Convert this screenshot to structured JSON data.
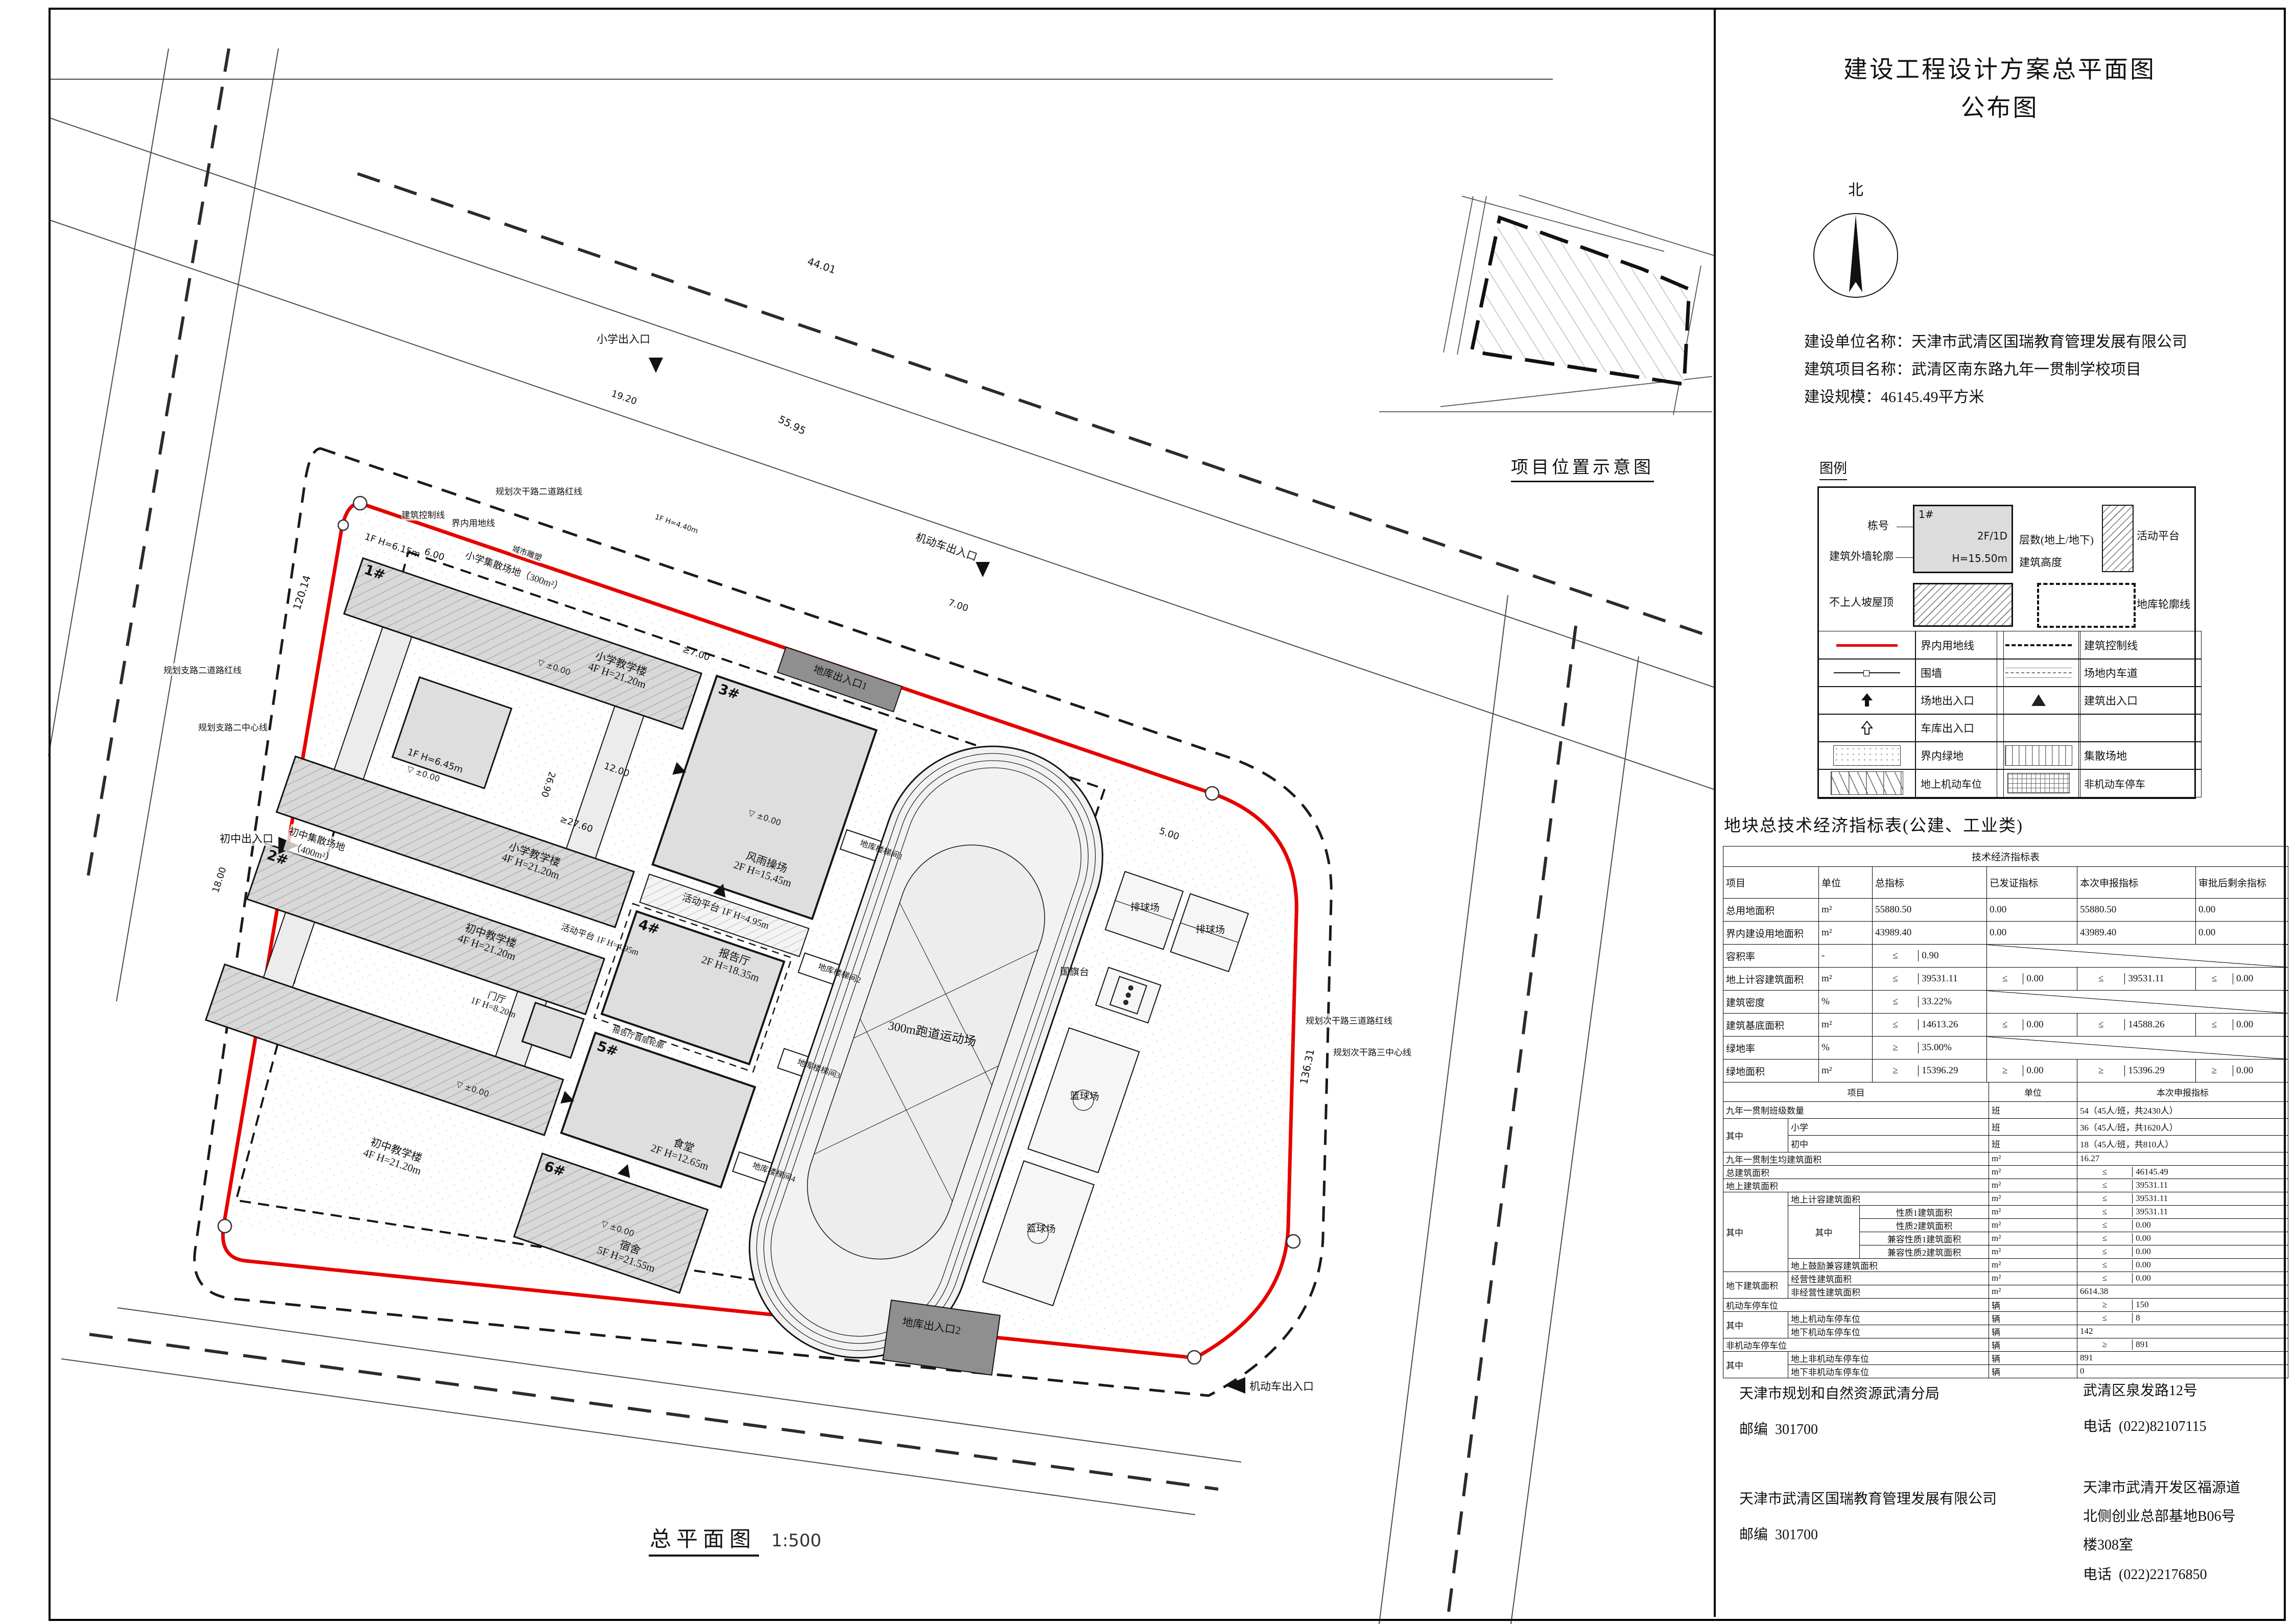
{
  "hdr": {
    "title1": "建设工程设计方案总平面图",
    "title2": "公布图",
    "north": "北"
  },
  "info": {
    "l1": "建设单位名称：天津市武清区国瑞教育管理发展有限公司",
    "l2": "建筑项目名称：武清区南东路九年一贯制学校项目",
    "l3": "建设规模：46145.49平方米"
  },
  "loc": {
    "title": "项目位置示意图"
  },
  "lg": {
    "title": "图例",
    "dong": "栋号",
    "dong_val": "1#",
    "wall": "建筑外墙轮廓",
    "floors_val": "2F/1D",
    "floors": "层数(地上/地下)",
    "h_val": "H=15.50m",
    "h": "建筑高度",
    "platform": "活动平台",
    "roof": "不上人坡屋顶",
    "garage": "地库轮廓线",
    "rows": [
      {
        "a": "界内用地线",
        "b": "建筑控制线"
      },
      {
        "a": "围墙",
        "b": "场地内车道"
      },
      {
        "a": "场地出入口",
        "b": "建筑出入口"
      },
      {
        "a": "车库出入口",
        "b": ""
      },
      {
        "a": "界内绿地",
        "b": "集散场地"
      },
      {
        "a": "地上机动车位",
        "b": "非机动车停车"
      }
    ]
  },
  "ec": {
    "title": "地块总技术经济指标表(公建、工业类)",
    "cap": "技术经济指标表",
    "h": {
      "item": "项目",
      "unit": "单位",
      "total": "总指标",
      "issued": "已发证指标",
      "declared": "本次申报指标",
      "remain": "审批后剩余指标"
    },
    "qz": "其中",
    "r1": {
      "name": "总用地面积",
      "unit": "m²",
      "t": "55880.50",
      "i": "0.00",
      "d": "55880.50",
      "r": "0.00"
    },
    "r2": {
      "name": "界内建设用地面积",
      "unit": "m²",
      "t": "43989.40",
      "i": "0.00",
      "d": "43989.40",
      "r": "0.00"
    },
    "r3": {
      "name": "容积率",
      "unit": "-",
      "op": "≤",
      "t": "0.90"
    },
    "r4": {
      "name": "地上计容建筑面积",
      "unit": "m²",
      "op": "≤",
      "t": "39531.11",
      "i": "0.00",
      "d": "39531.11",
      "r": "0.00"
    },
    "r5": {
      "name": "建筑密度",
      "unit": "%",
      "op": "≤",
      "t": "33.22%"
    },
    "r6": {
      "name": "建筑基底面积",
      "unit": "m²",
      "op": "≤",
      "t": "14613.26",
      "i": "0.00",
      "d": "14588.26",
      "r": "0.00"
    },
    "r7": {
      "name": "绿地率",
      "unit": "%",
      "op": "≥",
      "t": "35.00%"
    },
    "r8": {
      "name": "绿地面积",
      "unit": "m²",
      "op": "≥",
      "t": "15396.29",
      "i": "0.00",
      "d": "15396.29",
      "r": "0.00"
    },
    "h2": {
      "item": "项目",
      "unit": "单位",
      "declared": "本次申报指标"
    },
    "s1": {
      "name": "九年一贯制班级数量",
      "unit": "班",
      "v": "54（45人/班，共2430人）"
    },
    "s2": {
      "name": "小学",
      "unit": "班",
      "v": "36（45人/班，共1620人）"
    },
    "s3": {
      "name": "初中",
      "unit": "班",
      "v": "18（45人/班，共810人）"
    },
    "s4": {
      "name": "九年一贯制生均建筑面积",
      "unit": "m²",
      "v": "16.27"
    },
    "s5": {
      "name": "总建筑面积",
      "unit": "m²",
      "op": "≤",
      "v": "46145.49"
    },
    "s6": {
      "name": "地上建筑面积",
      "unit": "m²",
      "op": "≤",
      "v": "39531.11"
    },
    "s7": {
      "name": "地上计容建筑面积",
      "unit": "m²",
      "op": "≤",
      "v": "39531.11"
    },
    "s8": {
      "name": "性质1建筑面积",
      "unit": "m²",
      "op": "≤",
      "v": "39531.11"
    },
    "s9": {
      "name": "性质2建筑面积",
      "unit": "m²",
      "op": "≤",
      "v": "0.00"
    },
    "s10": {
      "name": "兼容性质1建筑面积",
      "unit": "m²",
      "op": "≤",
      "v": "0.00"
    },
    "s11": {
      "name": "兼容性质2建筑面积",
      "unit": "m²",
      "op": "≤",
      "v": "0.00"
    },
    "s12": {
      "name": "地上鼓励兼容建筑面积",
      "unit": "m²",
      "op": "≤",
      "v": "0.00"
    },
    "s13": {
      "name": "地下建筑面积"
    },
    "s13a": {
      "name": "经营性建筑面积",
      "unit": "m²",
      "op": "≤",
      "v": "0.00"
    },
    "s13b": {
      "name": "非经营性建筑面积",
      "unit": "m²",
      "v": "6614.38"
    },
    "s14": {
      "name": "机动车停车位",
      "unit": "辆",
      "op": "≥",
      "v": "150"
    },
    "s15": {
      "name": "地上机动车停车位",
      "unit": "辆",
      "op": "≤",
      "v": "8"
    },
    "s16": {
      "name": "地下机动车停车位",
      "unit": "辆",
      "v": "142"
    },
    "s17": {
      "name": "非机动车停车位",
      "unit": "辆",
      "op": "≥",
      "v": "891"
    },
    "s18": {
      "name": "地上非机动车停车位",
      "unit": "辆",
      "v": "891"
    },
    "s19": {
      "name": "地下非机动车停车位",
      "unit": "辆",
      "v": "0"
    }
  },
  "ct": {
    "zip_l": "邮编",
    "tel_l": "电话",
    "a_name": "天津市规划和自然资源武清分局",
    "a_zip": "301700",
    "a_addr": "武清区泉发路12号",
    "a_tel": "(022)82107115",
    "b_name": "天津市武清区国瑞教育管理发展有限公司",
    "b_zip": "301700",
    "b_a1": "天津市武清开发区福源道",
    "b_a2": "北侧创业总部基地B06号",
    "b_a3": "楼308室",
    "b_tel": "(022)22176850"
  },
  "pl": {
    "footer_title": "总平面图",
    "footer_scale": "1:500",
    "no1": "1#",
    "no2": "2#",
    "no3": "3#",
    "no4": "4#",
    "no5": "5#",
    "no6": "6#",
    "primary": "小学教学楼",
    "primary_hf": "4F H=21.20m",
    "middle": "初中教学楼",
    "middle_hf": "4F H=21.20m",
    "gym": "风雨操场",
    "gym_hf": "2F H=15.45m",
    "hall": "报告厅",
    "hall_hf": "2F H=18.35m",
    "canteen": "食堂",
    "canteen_hf": "2F H=12.65m",
    "dorm": "宿舍",
    "dorm_hf": "5F H=21.55m",
    "lobby": "门厅",
    "lobby_hf": "1F H=8.20m",
    "platform": "活动平台",
    "platform_hf": "1F H=4.95m",
    "aux1": "1F H=6.15m",
    "aux2": "1F H=6.45m",
    "guard": "1F H=4.40m",
    "track": "300m跑道运动场",
    "volleyball": "排球场",
    "basketball": "篮球场",
    "flag": "国旗台",
    "garage1": "地库出入口1",
    "garage2": "地库出入口2",
    "stair1": "地库楼梯间1",
    "stair2": "地库楼梯间2",
    "stair3": "地库楼梯间3",
    "stair4": "地库楼梯间4",
    "hall_outline": "报告厅首层轮廓",
    "entry_primary": "小学出入口",
    "entry_middle": "初中出入口",
    "entry_vehicle": "机动车出入口",
    "gather_primary": "小学集散场地（300m²）",
    "gather_middle1": "初中集散场地",
    "gather_middle2": "（400m²）",
    "sculpture": "城市雕塑",
    "line_ctrl": "建筑控制线",
    "line_boundary": "界内用地线",
    "road1": "规划次干路二道路红线",
    "road2": "规划支路二道路红线",
    "road3": "规划支路二中心线",
    "road4": "规划次干路三道路红线",
    "road5": "规划次干路三中心线",
    "level_mark": "▽ ±0.00",
    "dims": {
      "d1": "44.01",
      "d2": "55.95",
      "d3": "120.14",
      "d4": "136.31",
      "d5": "19.20",
      "d6": "7.00",
      "d7": "18.00",
      "d8": "12.00",
      "d9": "26.90",
      "d10": "≥27.60",
      "d11": "≥7.00",
      "d12": "5.00",
      "d13": "6.00"
    }
  }
}
